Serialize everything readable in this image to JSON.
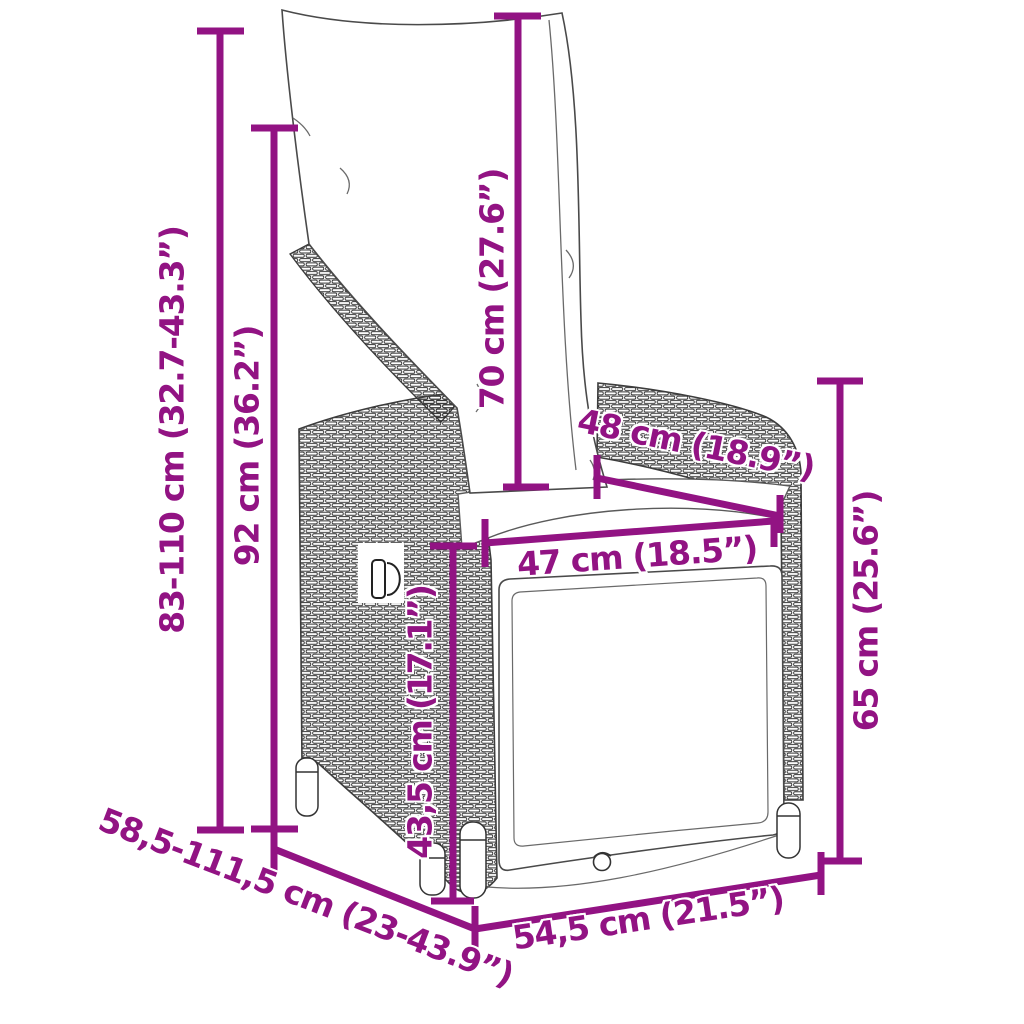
{
  "diagram": {
    "kind": "product-dimension-diagram",
    "subject": "reclining garden chair with cushions (poly rattan, side view)",
    "accent_color": "#921383",
    "art_line_color": "#3d3d3d",
    "background_color": "#ffffff"
  },
  "dimensions": {
    "overall_height": {
      "label": "83-110 cm (32.7-43.3”)"
    },
    "back_height": {
      "label": "92 cm (36.2”)"
    },
    "cushion_height": {
      "label": "70 cm (27.6”)"
    },
    "seat_depth": {
      "label": "48 cm (18.9”)"
    },
    "seat_width": {
      "label": "47 cm (18.5”)"
    },
    "armrest_height": {
      "label": "65 cm (25.6”)"
    },
    "seat_height": {
      "label": "43,5 cm (17.1”)"
    },
    "reclined_depth": {
      "label": "58,5-111,5 cm (23-43.9”)"
    },
    "base_width": {
      "label": "54,5 cm (21.5”)"
    }
  }
}
